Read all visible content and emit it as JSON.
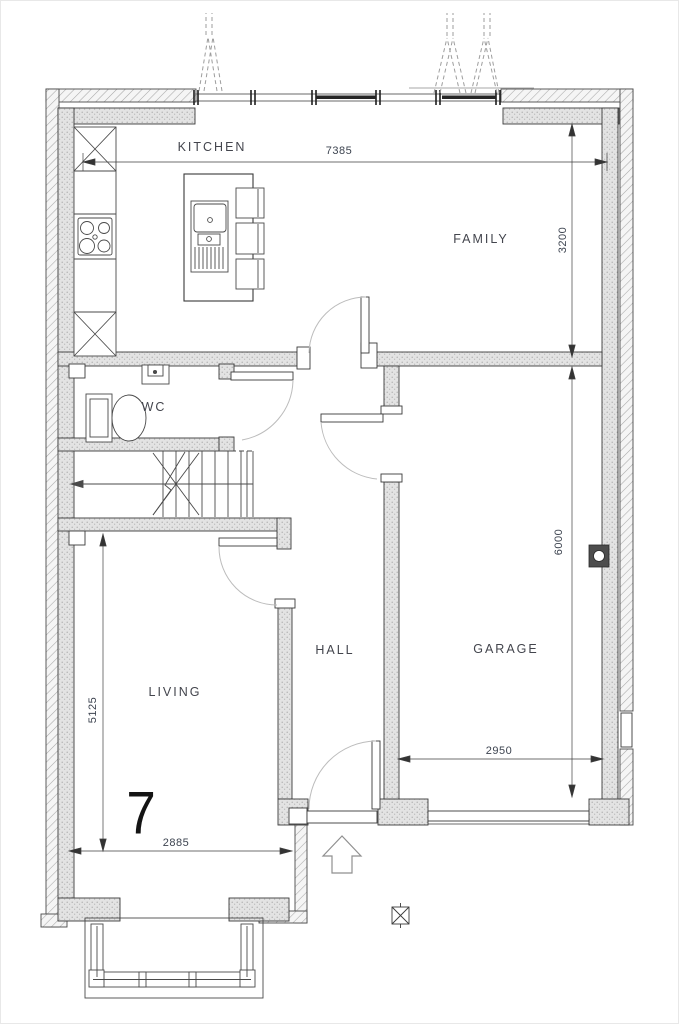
{
  "plot": {
    "number": "7"
  },
  "rooms": [
    {
      "id": "kitchen",
      "label": "KITCHEN"
    },
    {
      "id": "family",
      "label": "FAMILY"
    },
    {
      "id": "wc",
      "label": "WC"
    },
    {
      "id": "hall",
      "label": "HALL"
    },
    {
      "id": "living",
      "label": "LIVING"
    },
    {
      "id": "garage",
      "label": "GARAGE"
    }
  ],
  "dimensions_mm": [
    {
      "id": "kitchen-family-width",
      "label": "7385",
      "orientation": "horizontal"
    },
    {
      "id": "family-depth",
      "label": "3200",
      "orientation": "vertical"
    },
    {
      "id": "garage-depth",
      "label": "6000",
      "orientation": "vertical"
    },
    {
      "id": "garage-width",
      "label": "2950",
      "orientation": "horizontal"
    },
    {
      "id": "living-depth",
      "label": "5125",
      "orientation": "vertical"
    },
    {
      "id": "living-width",
      "label": "2885",
      "orientation": "horizontal"
    }
  ],
  "colors": {
    "line": "#3a3a3a",
    "wall_fill": "#e4e4e4",
    "hatch": "#a8a8a8",
    "door_arc": "#b9b9b9",
    "dim_text": "#3d4450",
    "label_text": "#43454d"
  }
}
